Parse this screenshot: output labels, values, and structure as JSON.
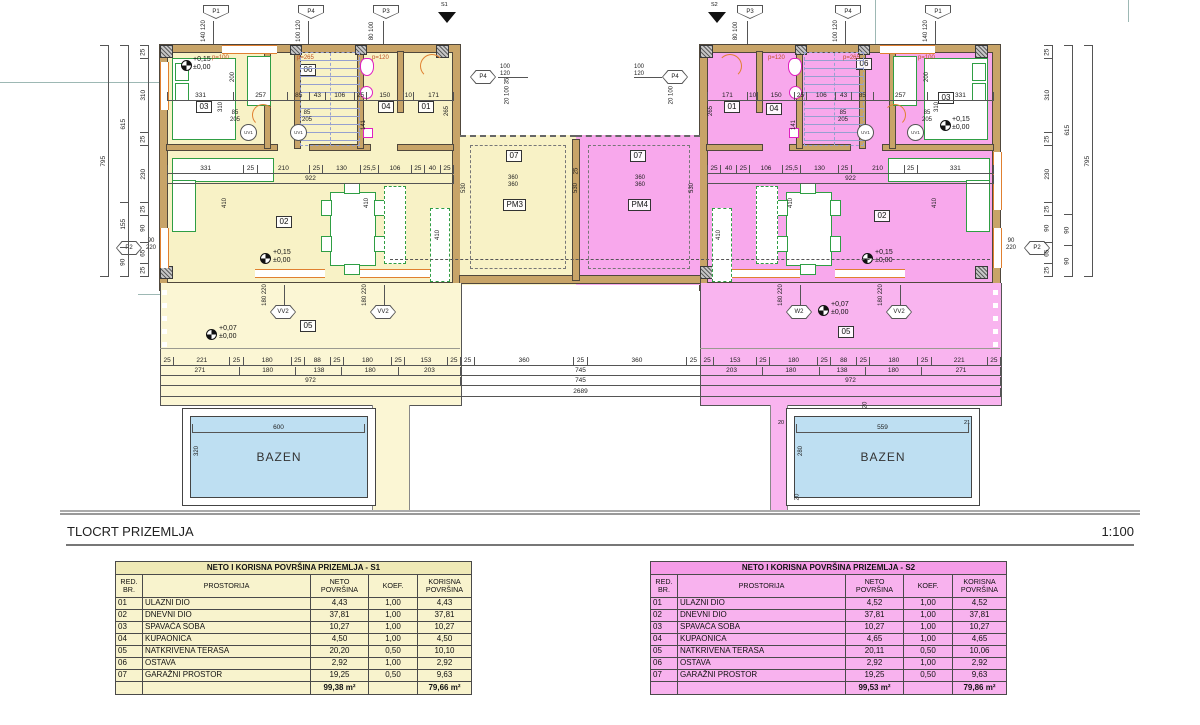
{
  "title": {
    "text": "TLOCRT PRIZEMLJA",
    "scale": "1:100"
  },
  "plan": {
    "flags_left": [
      {
        "id": "P1",
        "dims": "140 120"
      },
      {
        "id": "P4",
        "dims": "100 120"
      },
      {
        "id": "P3",
        "dims": "80 100"
      }
    ],
    "flags_right": [
      {
        "id": "P3",
        "dims": "80 100"
      },
      {
        "id": "P4",
        "dims": "100 120"
      },
      {
        "id": "P1",
        "dims": "140 120"
      }
    ],
    "garage_hex_left": {
      "id": "P4",
      "dims": "100\n120"
    },
    "garage_hex_right": {
      "id": "P4",
      "dims": "100\n120"
    },
    "side_hex_left": {
      "id": "P2",
      "dims": "90\n220"
    },
    "side_hex_right": {
      "id": "P2",
      "dims": "90\n220"
    },
    "entry_left": {
      "tag": "S1",
      "hex": "VV1",
      "dims": "140 220"
    },
    "entry_right": {
      "tag": "S2",
      "hex": "VV1",
      "dims": "140 220"
    },
    "uv": "UV1",
    "uv_dims": "85\n205",
    "vv2a": "VV2",
    "vv2b": "VV2",
    "w2": "W2",
    "vv2c": "VV2",
    "vv2_dims": "180 220",
    "p_labels": {
      "l1": "p=100",
      "l2": "p=265",
      "l3": "p=120",
      "r1": "p=120",
      "r2": "p=265",
      "r3": "p=100"
    },
    "rooms": {
      "r01": "01",
      "r02": "02",
      "r03": "03",
      "r04": "04",
      "r05": "05",
      "r06": "06",
      "r07": "07",
      "pm3": "PM3",
      "pm4": "PM4"
    },
    "elev": {
      "plus15": "+0,15\n±0,00",
      "plus07": "+0,07\n±0,00"
    },
    "pool_left": {
      "name": "BAZEN",
      "w": "600",
      "h": "320"
    },
    "pool_right": {
      "name": "BAZEN",
      "w": "559",
      "h": "280",
      "t": "20",
      "l": "20",
      "r": "21",
      "b": "20"
    },
    "dims": {
      "left_upper": [
        "331",
        "257",
        "85",
        "43",
        "106",
        "25",
        "150",
        "10",
        "171"
      ],
      "left_mid": [
        "331",
        "25",
        "210",
        "25",
        "130",
        "25,5",
        "106",
        "25",
        "40",
        "25"
      ],
      "left_mid_total": [
        "922"
      ],
      "right_upper": [
        "171",
        "10",
        "150",
        "25",
        "106",
        "43",
        "85",
        "257",
        "331"
      ],
      "right_mid": [
        "25",
        "40",
        "25",
        "106",
        "25,5",
        "130",
        "25",
        "210",
        "25",
        "331"
      ],
      "right_mid_total": [
        "922"
      ],
      "tl_r1": [
        "25",
        "221",
        "25",
        "180",
        "25",
        "88",
        "25",
        "180",
        "25",
        "153",
        "25"
      ],
      "tl_r2": [
        "271",
        "180",
        "138",
        "180",
        "203"
      ],
      "tl_r3": [
        "972"
      ],
      "mid_r1": [
        "25",
        "360",
        "25",
        "360",
        "25"
      ],
      "mid_r2": [
        "745"
      ],
      "mid_r3": [
        "745"
      ],
      "total_row": [
        "2689"
      ],
      "tr_r1": [
        "25",
        "153",
        "25",
        "180",
        "25",
        "88",
        "25",
        "180",
        "25",
        "221",
        "25"
      ],
      "tr_r2": [
        "203",
        "180",
        "138",
        "180",
        "271"
      ],
      "tr_r3": [
        "972"
      ],
      "lv1": [
        "25",
        "310",
        "25",
        "230",
        "25",
        "90",
        "65",
        "25"
      ],
      "lv2": [
        "615",
        "155",
        "90"
      ],
      "lv3": [
        "795"
      ],
      "rv1": [
        "25",
        "310",
        "25",
        "230",
        "25",
        "90",
        "65",
        "25"
      ],
      "rv2": [
        "615",
        "90",
        "90"
      ],
      "rv3": [
        "795"
      ],
      "v200": "200",
      "v310": "310",
      "v265": "265",
      "v141": "141",
      "v410": "410",
      "v530": "530",
      "g360": "360\n360",
      "g25": "25",
      "gtop": "20 100 35"
    }
  },
  "tables": {
    "s1": {
      "title": "NETO I KORISNA POVRŠINA PRIZEMLJA - S1",
      "headers": [
        "RED.\nBR.",
        "PROSTORIJA",
        "NETO\nPOVRŠINA",
        "KOEF.",
        "KORISNA\nPOVRŠINA"
      ],
      "rows": [
        [
          "01",
          "ULAZNI DIO",
          "4,43",
          "1,00",
          "4,43"
        ],
        [
          "02",
          "DNEVNI DIO",
          "37,81",
          "1,00",
          "37,81"
        ],
        [
          "03",
          "SPAVAĆA SOBA",
          "10,27",
          "1,00",
          "10,27"
        ],
        [
          "04",
          "KUPAONICA",
          "4,50",
          "1,00",
          "4,50"
        ],
        [
          "05",
          "NATKRIVENA TERASA",
          "20,20",
          "0,50",
          "10,10"
        ],
        [
          "06",
          "OSTAVA",
          "2,92",
          "1,00",
          "2,92"
        ],
        [
          "07",
          "GARAŽNI PROSTOR",
          "19,25",
          "0,50",
          "9,63"
        ]
      ],
      "totals": [
        "",
        "",
        "99,38 m²",
        "",
        "79,66 m²"
      ]
    },
    "s2": {
      "title": "NETO I KORISNA POVRŠINA PRIZEMLJA - S2",
      "headers": [
        "RED.\nBR.",
        "PROSTORIJA",
        "NETO\nPOVRŠINA",
        "KOEF.",
        "KORISNA\nPOVRŠINA"
      ],
      "rows": [
        [
          "01",
          "ULAZNI DIO",
          "4,52",
          "1,00",
          "4,52"
        ],
        [
          "02",
          "DNEVNI DIO",
          "37,81",
          "1,00",
          "37,81"
        ],
        [
          "03",
          "SPAVAĆA SOBA",
          "10,27",
          "1,00",
          "10,27"
        ],
        [
          "04",
          "KUPAONICA",
          "4,65",
          "1,00",
          "4,65"
        ],
        [
          "05",
          "NATKRIVENA TERASA",
          "20,11",
          "0,50",
          "10,06"
        ],
        [
          "06",
          "OSTAVA",
          "2,92",
          "1,00",
          "2,92"
        ],
        [
          "07",
          "GARAŽNI PROSTOR",
          "19,25",
          "0,50",
          "9,63"
        ]
      ],
      "totals": [
        "",
        "",
        "99,53 m²",
        "",
        "79,86 m²"
      ]
    }
  }
}
